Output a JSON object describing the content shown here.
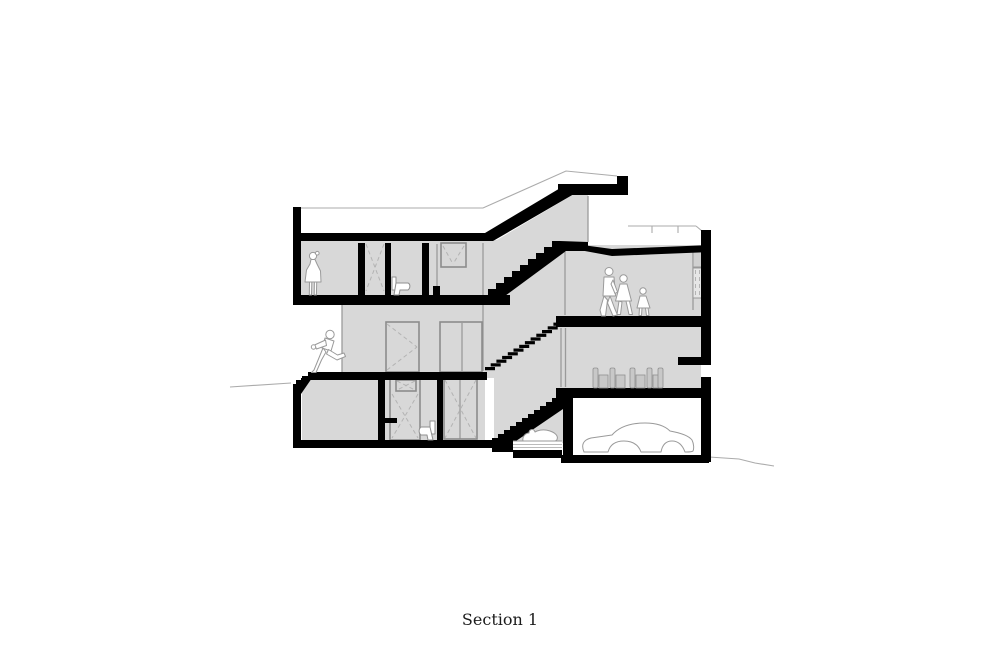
{
  "caption": {
    "text": "Section 1"
  },
  "drawing": {
    "type": "architectural-section",
    "colors": {
      "background": "#ffffff",
      "room_fill": "#d8d8d8",
      "structure": "#000000",
      "outline": "#9a9a9a",
      "light_line": "#ababab"
    },
    "figures": [
      "standing-girl",
      "running-boy",
      "walking-man",
      "walking-woman",
      "walking-child",
      "lying-cat",
      "car"
    ],
    "levels": [
      "top-floor",
      "middle-floor",
      "basement",
      "garage"
    ],
    "features": [
      "stair-three-flights",
      "roof-terrace-railing",
      "dining-chairs",
      "two-toilets",
      "pet-bed",
      "ground-line"
    ]
  }
}
